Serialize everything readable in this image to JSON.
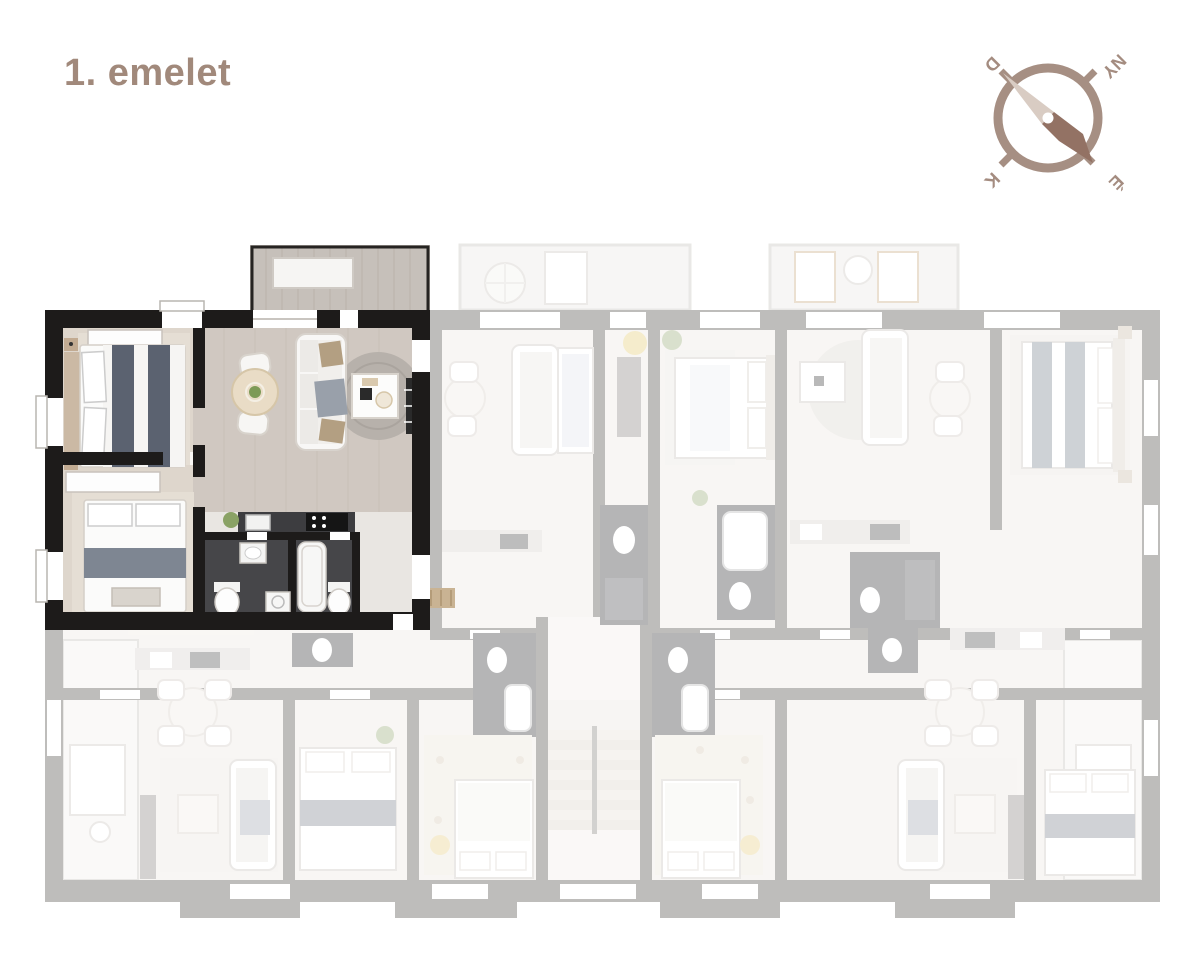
{
  "header": {
    "title": "1. emelet"
  },
  "compass": {
    "south_label": "D",
    "west_label": "NY",
    "east_label": "K",
    "north_label": "É"
  },
  "colors": {
    "accent_taupe": "#a1897b",
    "compass_ring": "#a68f83",
    "compass_needle_light": "#d9ccc3",
    "compass_needle_dark": "#937264",
    "highlighted_wall": "#1d1b1a",
    "faded_wall": "#57534f",
    "bath_floor_dark": "#464649",
    "wood_floor": "#d0c8c1",
    "duvet_stripe": "#5b6270"
  }
}
